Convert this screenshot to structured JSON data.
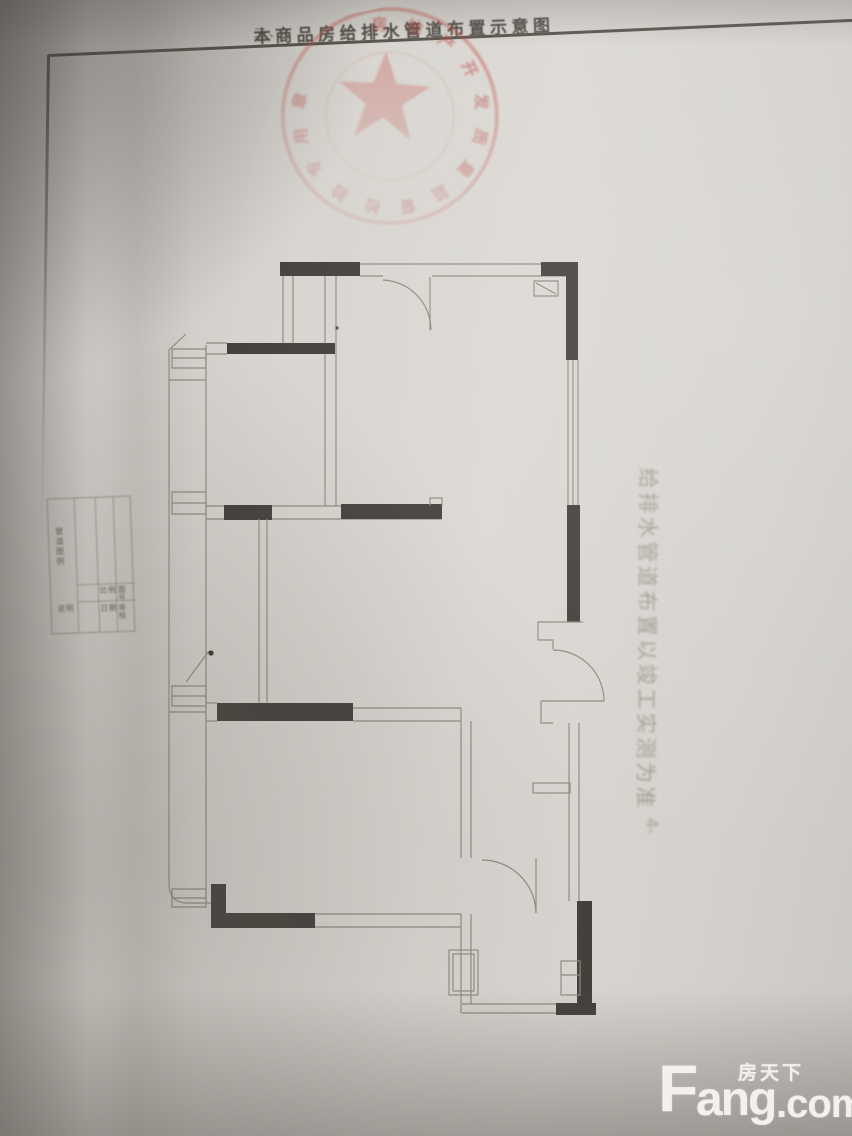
{
  "header": {
    "section_no": "二、",
    "title": "本商品房给排水管道布置示意图"
  },
  "seal": {
    "ring_text": "房地产开发质量监督检验专用章",
    "color": "#c4524c",
    "icon": "red-star"
  },
  "side_note": {
    "text": "给排水管道布置以竣工实测为准",
    "suffix": "4-"
  },
  "title_block": {
    "col_vertical": "管道图例",
    "cells": [
      "比例",
      "图号",
      "说明",
      "日期",
      "审核"
    ]
  },
  "watermark": {
    "cn": "房天下",
    "en_f": "F",
    "en_ang": "ang",
    "en_com": ".com"
  },
  "colors": {
    "paper": "#d7d4cf",
    "plan_line": "#8f8a82",
    "plan_wall": "#44413c",
    "seal_red": "#c4524c",
    "watermark": "#f5f3ef"
  }
}
